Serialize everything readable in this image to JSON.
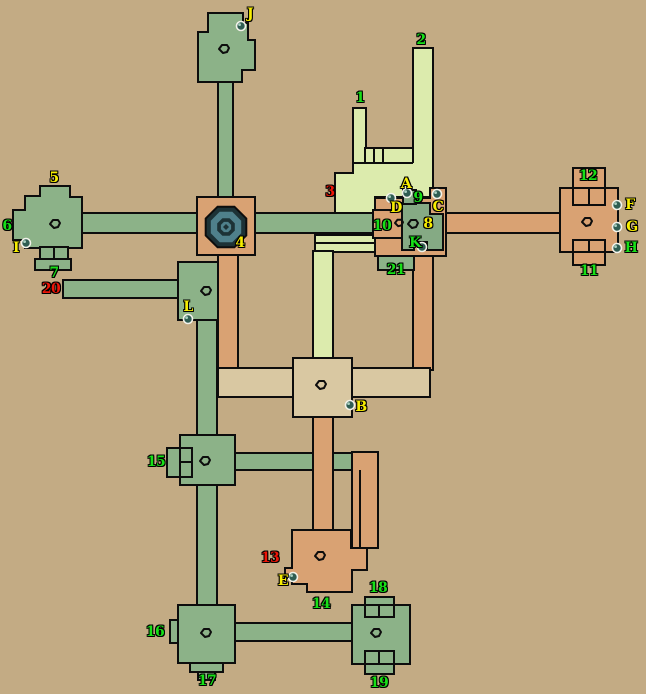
{
  "map": {
    "width": 646,
    "height": 694,
    "background": "#c3ab84",
    "colors": {
      "green": "#8cb288",
      "innergreen": "#85aa84",
      "orange": "#d9a273",
      "pale": "#dcebad",
      "tan": "#d9c8a2",
      "outline": "#0d0d0d",
      "well_dark": "#1d3236",
      "well_teal": "#4f808b",
      "orb_fill": "#2f5d52",
      "orb_ring": "#f2f2ea",
      "orb_shine": "#a8cfc0",
      "label_yellow": "#f8ee00",
      "label_green": "#17e017",
      "label_red": "#ee1507"
    },
    "shapes": [
      {
        "n": "building-3",
        "t": "poly",
        "c": "pale",
        "d": [
          353,
          148,
          353,
          108,
          366,
          108,
          366,
          148,
          413,
          148,
          413,
          48,
          433,
          48,
          433,
          197,
          375,
          197,
          375,
          252,
          343,
          252,
          343,
          217,
          335,
          217,
          335,
          173,
          353,
          173
        ]
      },
      {
        "n": "building-3-cells",
        "t": "rect",
        "c": "pale",
        "d": [
          365,
          148,
          18,
          15
        ]
      },
      {
        "n": "building-3-wall-a",
        "t": "line",
        "d": [
          352,
          163,
          413,
          163
        ]
      },
      {
        "n": "building-3-wall-b",
        "t": "line",
        "d": [
          374,
          148,
          374,
          163
        ]
      },
      {
        "n": "building-3-wall-c",
        "t": "line",
        "d": [
          413,
          148,
          413,
          163
        ]
      },
      {
        "n": "corridor-north",
        "t": "rect",
        "c": "green",
        "d": [
          218,
          82,
          15,
          115
        ]
      },
      {
        "n": "corridor-west",
        "t": "rect",
        "c": "green",
        "d": [
          82,
          213,
          115,
          20
        ]
      },
      {
        "n": "corridor-east",
        "t": "rect",
        "c": "green",
        "d": [
          255,
          213,
          120,
          20
        ]
      },
      {
        "n": "corridor-to-12",
        "t": "rect",
        "c": "orange",
        "d": [
          446,
          213,
          114,
          20
        ]
      },
      {
        "n": "corridor-south-4",
        "t": "rect",
        "c": "orange",
        "d": [
          218,
          255,
          20,
          113
        ]
      },
      {
        "n": "corridor-20",
        "t": "rect",
        "c": "green",
        "d": [
          63,
          280,
          115,
          18
        ]
      },
      {
        "n": "corridor-L-15",
        "t": "rect",
        "c": "green",
        "d": [
          197,
          320,
          20,
          115
        ]
      },
      {
        "n": "corridor-15-16",
        "t": "rect",
        "c": "green",
        "d": [
          197,
          485,
          20,
          120
        ]
      },
      {
        "n": "corridor-15-east",
        "t": "rect",
        "c": "green",
        "d": [
          235,
          453,
          117,
          17
        ]
      },
      {
        "n": "pale-lane-upper",
        "t": "rect",
        "c": "pale",
        "d": [
          315,
          235,
          63,
          9
        ]
      },
      {
        "n": "pale-lane-lower",
        "t": "rect",
        "c": "pale",
        "d": [
          315,
          243,
          63,
          9
        ]
      },
      {
        "n": "pale-stem-to-B",
        "t": "rect",
        "c": "pale",
        "d": [
          313,
          251,
          20,
          107
        ]
      },
      {
        "n": "orange-lane-complex",
        "t": "rect",
        "c": "orange",
        "d": [
          413,
          256,
          20,
          114
        ]
      },
      {
        "n": "tan-corridor",
        "t": "rect",
        "c": "tan",
        "d": [
          218,
          368,
          212,
          29
        ]
      },
      {
        "n": "room-B",
        "t": "rect",
        "c": "tan",
        "d": [
          293,
          358,
          59,
          59
        ]
      },
      {
        "n": "orange-lane-B-13",
        "t": "rect",
        "c": "orange",
        "d": [
          313,
          417,
          20,
          115
        ]
      },
      {
        "n": "loop-corridor",
        "t": "rect",
        "c": "orange",
        "d": [
          352,
          452,
          26,
          96
        ]
      },
      {
        "n": "loop-corridor-wall",
        "t": "line",
        "d": [
          360,
          470,
          360,
          548
        ]
      },
      {
        "n": "room-13-14",
        "t": "poly",
        "c": "orange",
        "d": [
          292,
          530,
          351,
          530,
          351,
          548,
          367,
          548,
          367,
          570,
          352,
          570,
          352,
          592,
          307,
          592,
          307,
          584,
          292,
          584,
          292,
          578,
          285,
          578,
          285,
          568,
          292,
          568
        ]
      },
      {
        "n": "corridor-16-east",
        "t": "rect",
        "c": "green",
        "d": [
          235,
          623,
          117,
          18
        ]
      },
      {
        "n": "room-J",
        "t": "poly",
        "c": "green",
        "d": [
          208,
          13,
          243,
          13,
          243,
          23,
          248,
          23,
          248,
          40,
          255,
          40,
          255,
          70,
          242,
          70,
          242,
          82,
          198,
          82,
          198,
          32,
          208,
          32
        ]
      },
      {
        "n": "room-5",
        "t": "poly",
        "c": "green",
        "d": [
          40,
          186,
          70,
          186,
          70,
          197,
          82,
          197,
          82,
          248,
          25,
          248,
          25,
          240,
          13,
          240,
          13,
          210,
          25,
          210,
          25,
          196,
          40,
          196
        ]
      },
      {
        "n": "room-5-doors",
        "t": "rect",
        "c": "green",
        "d": [
          40,
          247,
          28,
          12
        ]
      },
      {
        "n": "room-5-door-div",
        "t": "line",
        "d": [
          54,
          247,
          54,
          259
        ]
      },
      {
        "n": "room-5-porch",
        "t": "rect",
        "c": "green",
        "d": [
          35,
          259,
          36,
          11
        ]
      },
      {
        "n": "room-4",
        "t": "rect",
        "c": "orange",
        "d": [
          197,
          197,
          58,
          58
        ]
      },
      {
        "n": "room-L",
        "t": "rect",
        "c": "green",
        "d": [
          178,
          262,
          40,
          58
        ]
      },
      {
        "n": "room-15",
        "t": "rect",
        "c": "green",
        "d": [
          180,
          435,
          55,
          50
        ]
      },
      {
        "n": "room-15-porch",
        "t": "rect",
        "c": "green",
        "d": [
          167,
          448,
          13,
          29
        ]
      },
      {
        "n": "room-15-doors",
        "t": "rect",
        "c": "green",
        "d": [
          180,
          448,
          12,
          29
        ]
      },
      {
        "n": "room-15-door-div",
        "t": "line",
        "d": [
          180,
          462,
          192,
          462
        ]
      },
      {
        "n": "room-16",
        "t": "rect",
        "c": "green",
        "d": [
          178,
          605,
          57,
          58
        ]
      },
      {
        "n": "room-16-bump",
        "t": "rect",
        "c": "green",
        "d": [
          170,
          620,
          8,
          23
        ]
      },
      {
        "n": "room-16-step1",
        "t": "rect",
        "c": "green",
        "d": [
          190,
          663,
          33,
          9
        ]
      },
      {
        "n": "room-16-step2",
        "t": "rect",
        "c": "green",
        "d": [
          198,
          672,
          17,
          8
        ]
      },
      {
        "n": "room-18-19",
        "t": "rect",
        "c": "green",
        "d": [
          352,
          605,
          58,
          59
        ]
      },
      {
        "n": "room-18-porch",
        "t": "rect",
        "c": "green",
        "d": [
          365,
          597,
          29,
          8
        ]
      },
      {
        "n": "room-18-doors",
        "t": "rect",
        "c": "green",
        "d": [
          365,
          605,
          29,
          12
        ]
      },
      {
        "n": "room-18-door-div",
        "t": "line",
        "d": [
          379,
          605,
          379,
          617
        ]
      },
      {
        "n": "room-19-doors",
        "t": "rect",
        "c": "green",
        "d": [
          365,
          651,
          29,
          13
        ]
      },
      {
        "n": "room-19-door-div",
        "t": "line",
        "d": [
          379,
          651,
          379,
          664
        ]
      },
      {
        "n": "room-19-porch",
        "t": "rect",
        "c": "green",
        "d": [
          365,
          664,
          29,
          10
        ]
      },
      {
        "n": "complex-outer",
        "t": "poly",
        "c": "orange",
        "d": [
          375,
          198,
          403,
          198,
          403,
          190,
          416,
          190,
          416,
          198,
          430,
          198,
          430,
          188,
          446,
          188,
          446,
          256,
          375,
          256
        ]
      },
      {
        "n": "complex-21-yard",
        "t": "rect",
        "c": "green",
        "d": [
          378,
          256,
          36,
          14
        ]
      },
      {
        "n": "complex-inner-room",
        "t": "poly",
        "c": "innergreen",
        "d": [
          402,
          203,
          430,
          203,
          430,
          214,
          443,
          214,
          443,
          250,
          427,
          250,
          427,
          242,
          414,
          242,
          414,
          250,
          402,
          250
        ]
      },
      {
        "n": "complex-north-cell",
        "t": "rect",
        "c": "innergreen",
        "d": [
          403,
          190,
          13,
          14
        ]
      },
      {
        "n": "complex-sub-room-10",
        "t": "rect",
        "c": "orange",
        "d": [
          373,
          210,
          29,
          28
        ]
      },
      {
        "n": "room-12-porch",
        "t": "rect",
        "c": "orange",
        "d": [
          573,
          168,
          32,
          20
        ]
      },
      {
        "n": "room-11-12",
        "t": "rect",
        "c": "orange",
        "d": [
          560,
          188,
          58,
          64
        ]
      },
      {
        "n": "room-12-doors",
        "t": "rect",
        "c": "orange",
        "d": [
          573,
          188,
          32,
          17
        ]
      },
      {
        "n": "room-12-door-div",
        "t": "line",
        "d": [
          589,
          188,
          589,
          205
        ]
      },
      {
        "n": "room-11-doors",
        "t": "rect",
        "c": "orange",
        "d": [
          573,
          240,
          32,
          12
        ]
      },
      {
        "n": "room-11-door-div",
        "t": "line",
        "d": [
          589,
          240,
          589,
          252
        ]
      },
      {
        "n": "room-11-porch",
        "t": "rect",
        "c": "orange",
        "d": [
          573,
          252,
          32,
          13
        ]
      }
    ],
    "well": {
      "x": 226,
      "y": 227,
      "rings": [
        22,
        16.5,
        9.5,
        5.5
      ],
      "diamond": 3
    },
    "room_icons": [
      {
        "n": "room-icon-J",
        "x": 224,
        "y": 49
      },
      {
        "n": "room-icon-5",
        "x": 55,
        "y": 224
      },
      {
        "n": "room-icon-L",
        "x": 206,
        "y": 291
      },
      {
        "n": "room-icon-15",
        "x": 205,
        "y": 461
      },
      {
        "n": "room-icon-16",
        "x": 206,
        "y": 633
      },
      {
        "n": "room-icon-18-19",
        "x": 376,
        "y": 633
      },
      {
        "n": "room-icon-B",
        "x": 321,
        "y": 385
      },
      {
        "n": "room-icon-13-14",
        "x": 320,
        "y": 556
      },
      {
        "n": "room-icon-11-12",
        "x": 587,
        "y": 222
      },
      {
        "n": "room-icon-9",
        "x": 413,
        "y": 224
      },
      {
        "n": "room-icon-10-door",
        "x": 399,
        "y": 223,
        "s": 0.8
      }
    ],
    "markers": [
      {
        "id": "J",
        "x": 241,
        "y": 26
      },
      {
        "id": "I",
        "x": 26,
        "y": 243
      },
      {
        "id": "L",
        "x": 188,
        "y": 319
      },
      {
        "id": "D",
        "x": 391,
        "y": 198
      },
      {
        "id": "A",
        "x": 407,
        "y": 193
      },
      {
        "id": "C",
        "x": 437,
        "y": 194
      },
      {
        "id": "K",
        "x": 422,
        "y": 247
      },
      {
        "id": "B",
        "x": 350,
        "y": 405
      },
      {
        "id": "E",
        "x": 293,
        "y": 577
      },
      {
        "id": "F",
        "x": 617,
        "y": 205
      },
      {
        "id": "G",
        "x": 617,
        "y": 227
      },
      {
        "id": "H",
        "x": 617,
        "y": 248
      }
    ],
    "labels": [
      {
        "text": "J",
        "x": 250,
        "y": 14,
        "color": "yellow"
      },
      {
        "text": "2",
        "x": 421,
        "y": 40,
        "color": "green"
      },
      {
        "text": "1",
        "x": 360,
        "y": 98,
        "color": "green"
      },
      {
        "text": "5",
        "x": 54,
        "y": 178,
        "color": "yellow"
      },
      {
        "text": "3",
        "x": 330,
        "y": 192,
        "color": "red"
      },
      {
        "text": "A",
        "x": 406,
        "y": 184,
        "color": "yellow"
      },
      {
        "text": "9",
        "x": 418,
        "y": 198,
        "color": "green"
      },
      {
        "text": "D",
        "x": 396,
        "y": 208,
        "color": "yellow"
      },
      {
        "text": "C",
        "x": 438,
        "y": 207,
        "color": "yellow"
      },
      {
        "text": "12",
        "x": 588,
        "y": 176,
        "color": "green"
      },
      {
        "text": "F",
        "x": 630,
        "y": 205,
        "color": "yellow"
      },
      {
        "text": "6",
        "x": 7,
        "y": 226,
        "color": "green"
      },
      {
        "text": "10",
        "x": 382,
        "y": 226,
        "color": "green"
      },
      {
        "text": "8",
        "x": 428,
        "y": 224,
        "color": "yellow"
      },
      {
        "text": "G",
        "x": 632,
        "y": 227,
        "color": "yellow"
      },
      {
        "text": "4",
        "x": 240,
        "y": 243,
        "color": "yellow"
      },
      {
        "text": "K",
        "x": 415,
        "y": 243,
        "color": "green"
      },
      {
        "text": "I",
        "x": 16,
        "y": 248,
        "color": "yellow"
      },
      {
        "text": "H",
        "x": 631,
        "y": 248,
        "color": "green"
      },
      {
        "text": "21",
        "x": 396,
        "y": 270,
        "color": "green"
      },
      {
        "text": "11",
        "x": 589,
        "y": 271,
        "color": "green"
      },
      {
        "text": "7",
        "x": 54,
        "y": 273,
        "color": "green"
      },
      {
        "text": "20",
        "x": 51,
        "y": 289,
        "color": "red"
      },
      {
        "text": "L",
        "x": 188,
        "y": 307,
        "color": "yellow"
      },
      {
        "text": "B",
        "x": 361,
        "y": 407,
        "color": "yellow"
      },
      {
        "text": "15",
        "x": 156,
        "y": 462,
        "color": "green"
      },
      {
        "text": "13",
        "x": 270,
        "y": 558,
        "color": "red"
      },
      {
        "text": "E",
        "x": 283,
        "y": 581,
        "color": "yellow"
      },
      {
        "text": "18",
        "x": 378,
        "y": 588,
        "color": "green"
      },
      {
        "text": "14",
        "x": 321,
        "y": 604,
        "color": "green"
      },
      {
        "text": "16",
        "x": 155,
        "y": 632,
        "color": "green"
      },
      {
        "text": "17",
        "x": 207,
        "y": 681,
        "color": "green"
      },
      {
        "text": "19",
        "x": 379,
        "y": 683,
        "color": "green"
      }
    ]
  }
}
